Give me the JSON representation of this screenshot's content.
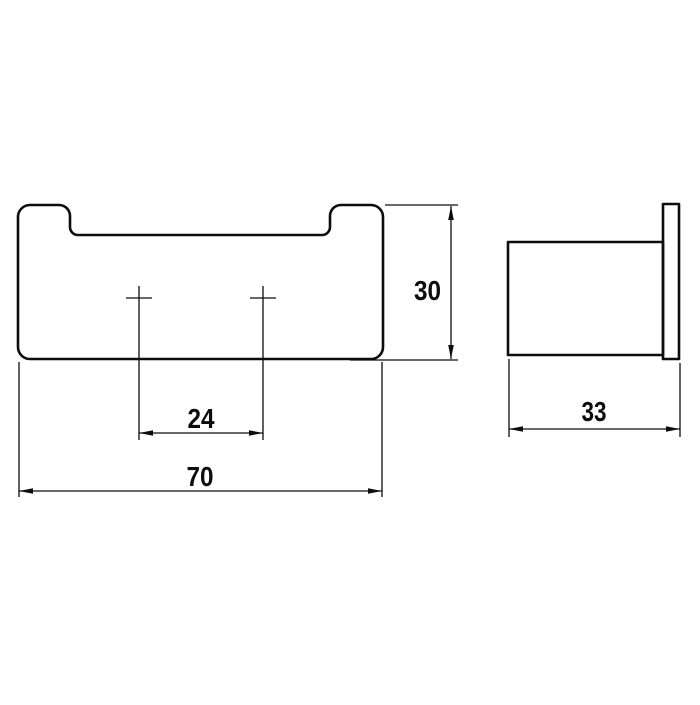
{
  "colors": {
    "background": "#ffffff",
    "line": "#0d0d0d"
  },
  "dimensions": {
    "overall_width": "70",
    "hole_spacing": "24",
    "overall_height": "30",
    "overall_depth": "33"
  }
}
